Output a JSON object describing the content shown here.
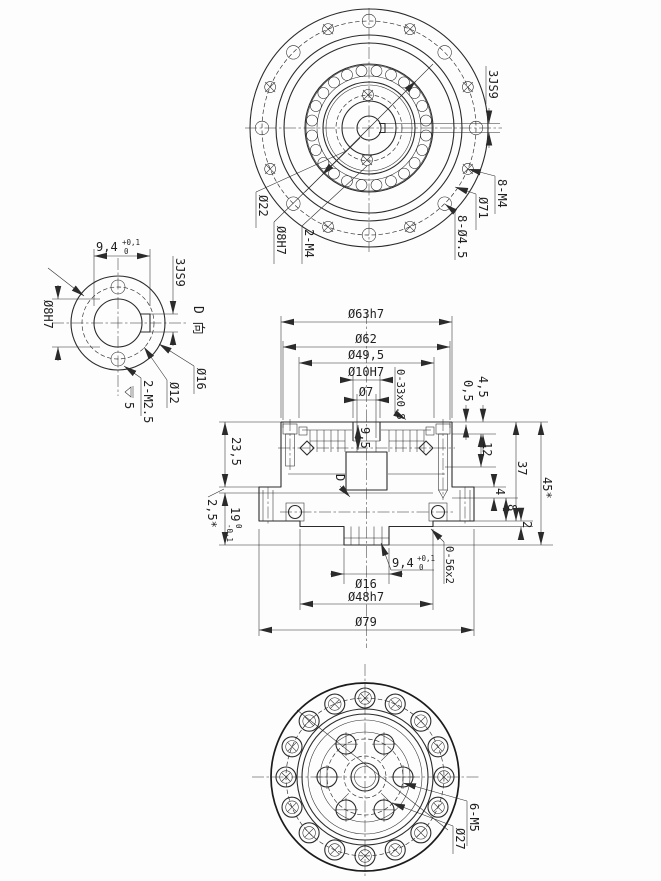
{
  "colors": {
    "line": "#2b2b2b",
    "background": "#fdfdfd"
  },
  "top_view": {
    "labels": {
      "keyway": "3JS9",
      "tapped8": "8-M4",
      "bolt_circle": "Ø71",
      "thru8": "8-Ø4.5",
      "circle22": "Ø22",
      "center_hole": "Ø8H7",
      "tapped2": "2-M4"
    }
  },
  "d_view": {
    "title": "D 向",
    "labels": {
      "width": "9,4",
      "width_tol_up": "+0,1",
      "width_tol_dn": "0",
      "keyway": "3JS9",
      "center_hole": "Ø8H7",
      "outer": "Ø16",
      "bolt_circle": "Ø12",
      "tapped": "2-M2.5",
      "depth": "5"
    }
  },
  "section_view": {
    "top": {
      "d63": "Ø63h7",
      "d62": "Ø62",
      "d49": "Ø49,5",
      "d10": "Ø10H7",
      "d7": "Ø7",
      "oring": "0-33x0.8"
    },
    "right": {
      "r05": "0,5",
      "r45": "4,5",
      "r12": "12",
      "r37": "37",
      "r45s": "45*",
      "r4": "4",
      "r8": "8",
      "r2": "2",
      "oring": "0-56x2"
    },
    "left": {
      "l235": "23,5",
      "l25s": "2,5*",
      "l19": "19",
      "l19_tol_up": "0",
      "l19_tol_dn": "-0,1"
    },
    "middle": {
      "m95": "9,5",
      "view_arrow": "D"
    },
    "bottom": {
      "b94": "9,4",
      "b94_tol_up": "+0,1",
      "b94_tol_dn": "0",
      "d16": "Ø16",
      "d48": "Ø48h7",
      "d79": "Ø79"
    }
  },
  "bottom_view": {
    "labels": {
      "tapped6": "6-M5",
      "bolt_circle": "Ø27"
    }
  }
}
